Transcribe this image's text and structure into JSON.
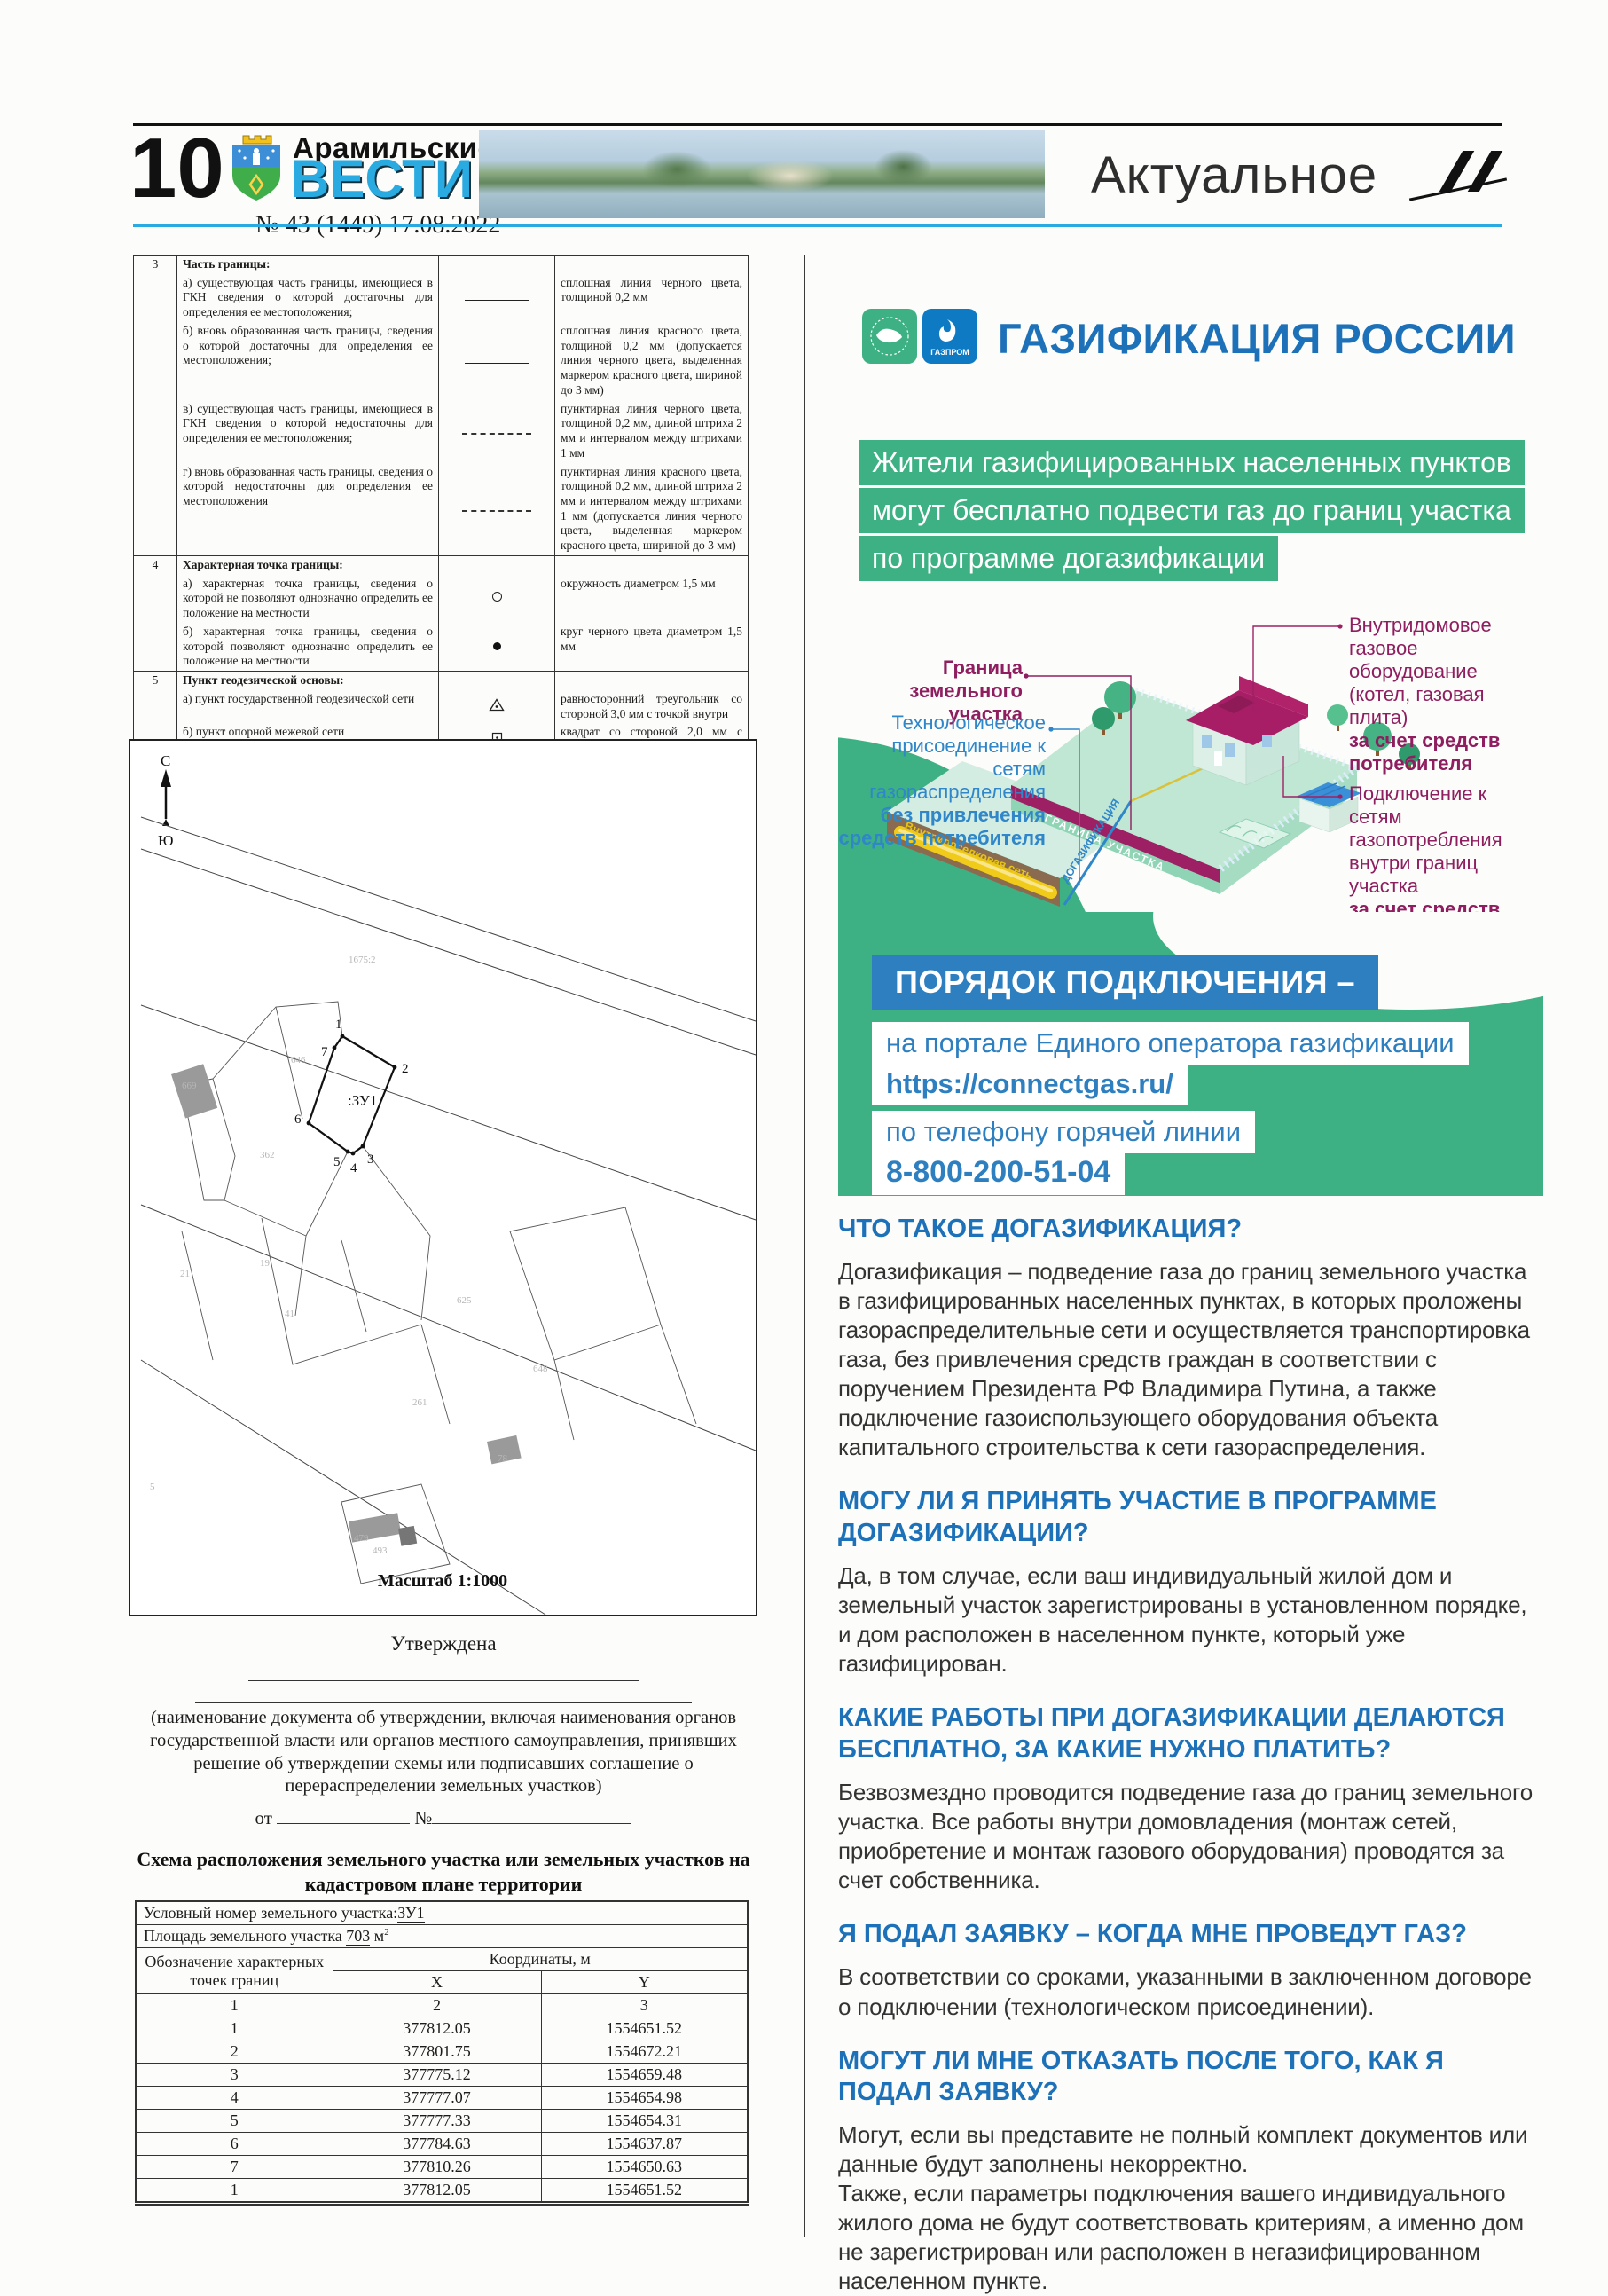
{
  "colors": {
    "accent_green": "#3db183",
    "title_blue": "#1d71b8",
    "panel_blue": "#2d7fc0",
    "light_blue": "#29abe2",
    "magenta": "#8e1e5f"
  },
  "header": {
    "page_number": "10",
    "paper_name_line1": "Арамильские",
    "paper_name_line2": "ВЕСТИ",
    "issue_info": "№ 43 (1449) 17.08.2022",
    "section_title": "Актуальное"
  },
  "legend": {
    "r3": {
      "num": "3",
      "title": "Часть границы:",
      "a": "а) существующая часть границы, имеющиеся в ГКН сведения о которой достаточны для определения ее местоположения;",
      "a_spec": "сплошная линия черного цвета, толщиной 0,2 мм",
      "b": "б) вновь образованная часть границы, сведения о которой достаточны для определения ее местоположения;",
      "b_spec": "сплошная линия красного цвета, толщиной 0,2 мм (допускается линия черного цвета, выделенная маркером красного цвета, шириной до 3 мм)",
      "v": "в) существующая часть границы, имеющиеся в ГКН сведения о которой недостаточны для определения ее местоположения;",
      "v_spec": "пунктирная линия черного цвета, толщиной 0,2 мм, длиной штриха 2 мм и интервалом между штрихами 1 мм",
      "g": "г) вновь образованная часть границы, сведения о которой недостаточны для определения ее местоположения",
      "g_spec": "пунктирная линия красного цвета, толщиной 0,2 мм, длиной штриха 2 мм и интервалом между штрихами 1 мм (допускается линия черного цвета, выделенная маркером красного цвета, шириной до 3 мм)"
    },
    "r4": {
      "num": "4",
      "title": "Характерная точка границы:",
      "a": "а) характерная точка границы, сведения о которой не позволяют однозначно определить ее положение на местности",
      "a_spec": "окружность диаметром 1,5 мм",
      "b": "б) характерная точка границы, сведения о которой позволяют однозначно определить ее положение на местности",
      "b_spec": "круг черного цвета диаметром 1,5 мм"
    },
    "r5": {
      "num": "5",
      "title": "Пункт геодезической основы:",
      "a": "а) пункт государственной геодезической сети",
      "a_spec": "равносторонний треугольник со стороной 3,0 мм с точкой внутри",
      "b": "б) пункт опорной межевой сети",
      "b_spec": "квадрат со стороной 2,0 мм с точкой внутри"
    },
    "r6": {
      "num": "6",
      "title": "Точка съемочного обоснования",
      "spec": "окружность диаметром 1, мм с точкой внутри"
    },
    "r7": {
      "num": "7",
      "title": "Направления геодезических построений при создании съемочного обоснования",
      "spec": "сплошная линия черного цвета толщиной 0,5 мм"
    },
    "r8": {
      "num": "8",
      "title": "Направления геодезических построений при определении координат характерных точек границ земельного участка",
      "spec": "сплошная линия черного цвета со стрелкой толщиной 0,2 мм"
    },
    "footnote": "¹Для обозначения образуемых земельных участков, размеры которых не могут быть переданы в масштабе разделов графической части, применяются условные знаки №2 (а, б), выполненные красным цветом (допускается знак, выполненный черным цветом, выделять маркером красного цвета)"
  },
  "map": {
    "north": "С",
    "south": "Ю",
    "parcel": ":ЗУ1",
    "v1": "1",
    "v2": "2",
    "v3": "3",
    "v4": "4",
    "v5": "5",
    "v6": "6",
    "v7": "7",
    "faint": [
      "1675:2",
      "646",
      "669",
      "362",
      "19",
      "21",
      "41",
      "625",
      "648",
      "261",
      "78",
      "5",
      "479",
      "493"
    ],
    "scale": "Масштаб 1:1000"
  },
  "approval": {
    "approved": "Утверждена",
    "note": "(наименование документа об утверждении, включая наименования органов государственной власти или органов местного самоуправления, принявших решение об утверждении схемы или подписавших соглашение о перераспределении земельных участков)",
    "from": "от",
    "no": "№"
  },
  "scheme": {
    "title": "Схема расположения земельного участка или земельных участков на кадастровом плане территории",
    "num_label": "Условный номер земельного участка:",
    "num_value": "ЗУ1",
    "area_label": "Площадь земельного участка",
    "area_value": "703",
    "area_unit": "м",
    "area_sup": "2",
    "col_points": "Обозначение характерных точек границ",
    "col_coords": "Координаты, м",
    "col_x": "X",
    "col_y": "Y",
    "idx": [
      "1",
      "2",
      "3"
    ],
    "points": [
      {
        "n": "1",
        "x": "377812.05",
        "y": "1554651.52"
      },
      {
        "n": "2",
        "x": "377801.75",
        "y": "1554672.21"
      },
      {
        "n": "3",
        "x": "377775.12",
        "y": "1554659.48"
      },
      {
        "n": "4",
        "x": "377777.07",
        "y": "1554654.98"
      },
      {
        "n": "5",
        "x": "377777.33",
        "y": "1554654.31"
      },
      {
        "n": "6",
        "x": "377784.63",
        "y": "1554637.87"
      },
      {
        "n": "7",
        "x": "377810.26",
        "y": "1554650.63"
      },
      {
        "n": "1",
        "x": "377812.05",
        "y": "1554651.52"
      }
    ]
  },
  "info": {
    "title": "ГАЗИФИКАЦИЯ РОССИИ",
    "gazprom": "ГАЗПРОМ",
    "lead1": "Жители газифицированных населенных пунктов",
    "lead2": "могут бесплатно подвести газ до границ участка",
    "lead3": "по программе догазификации",
    "ill": {
      "boundary1": "Граница",
      "boundary2": "земельного участка",
      "tech": "Технологическое присоединение к сетям газораспределения",
      "tech_b": "без привлечения средств потребителя",
      "indoor": "Внутридомовое газовое оборудование (котел, газовая плита)",
      "indoor_b": "за счет средств потребителя",
      "connect": "Подключение к сетям газопотребления внутри границ участка",
      "connect_b": "за счет средств потребителя",
      "dogas": "ДОГАЗИФИКАЦИЯ",
      "border_band": "ГРАНИЦА УЧАСТКА",
      "network": "Внутрипоселковая сеть"
    },
    "order": {
      "heading": "ПОРЯДОК ПОДКЛЮЧЕНИЯ –",
      "portal": "на портале Единого оператора газификации",
      "url": "https://connectgas.ru/",
      "phone": "по телефону горячей линии",
      "number": "8-800-200-51-04"
    },
    "faq": [
      {
        "q": "ЧТО ТАКОЕ ДОГАЗИФИКАЦИЯ?",
        "a": "Догазификация – подведение газа до границ земельного участка в газифицированных населенных пунктах, в которых проложены газораспределительные сети и осуществляется транспортировка газа, без привлечения средств граждан в соответствии с поручением Президента РФ Владимира Путина, а также подключение газоиспользующего оборудования объекта капитального строительства к сети газораспределения."
      },
      {
        "q": "МОГУ ЛИ Я ПРИНЯТЬ УЧАСТИЕ В ПРОГРАММЕ ДОГАЗИФИКАЦИИ?",
        "a": "Да, в том случае, если ваш индивидуальный жилой дом и земельный участок зарегистрированы в установленном порядке, и дом расположен в населенном пункте, который уже газифицирован."
      },
      {
        "q": "КАКИЕ РАБОТЫ ПРИ ДОГАЗИФИКАЦИИ ДЕЛАЮТСЯ БЕСПЛАТНО, ЗА КАКИЕ НУЖНО ПЛАТИТЬ?",
        "a": "Безвозмездно проводится подведение газа до границ земельного участка. Все работы внутри домовладения (монтаж сетей, приобретение и монтаж газового оборудования) проводятся за счет собственника."
      },
      {
        "q": "Я ПОДАЛ ЗАЯВКУ – КОГДА МНЕ ПРОВЕДУТ ГАЗ?",
        "a": "В соответствии со сроками, указанными в заключенном договоре о подключении (технологическом присоединении)."
      },
      {
        "q": "МОГУТ ЛИ МНЕ ОТКАЗАТЬ ПОСЛЕ ТОГО, КАК Я ПОДАЛ ЗАЯВКУ?",
        "a": "Могут, если вы представите не полный комплект документов или данные будут заполнены некорректно.\nТакже, если параметры подключения вашего индивидуального жилого дома не будут соответствовать критериям, а именно дом не зарегистрирован или расположен в негазифицированном населенном пункте."
      }
    ]
  }
}
